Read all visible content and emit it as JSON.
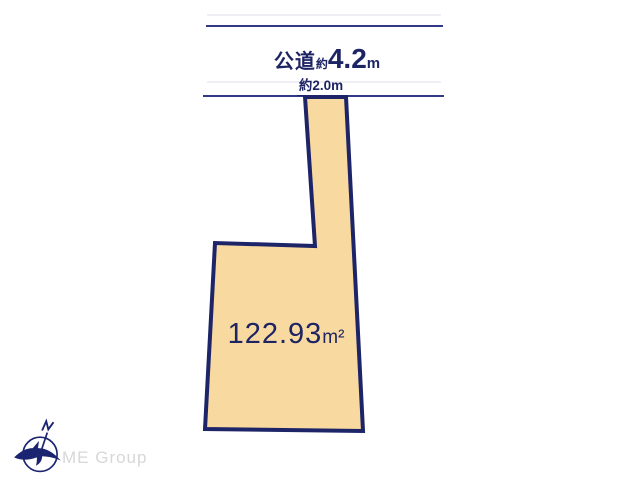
{
  "diagram": {
    "road": {
      "name": "公道",
      "approx_prefix": "約",
      "width_value": "4.2",
      "unit": "m"
    },
    "entrance": {
      "label": "約2.0m"
    },
    "lot": {
      "area_value": "122.93",
      "area_unit": "m²",
      "points": "305,97 346,97 363,431 205,429 215,243 315,246"
    }
  },
  "branding": {
    "company": "ME Group"
  },
  "colors": {
    "navy_line": "#333a85",
    "navy_border": "#1d2468",
    "navy_text": "#1d2464",
    "lot_fill": "#f8d9a0",
    "faint_line": "#e4e4ee",
    "logo_gray": "#d7d7d7"
  }
}
